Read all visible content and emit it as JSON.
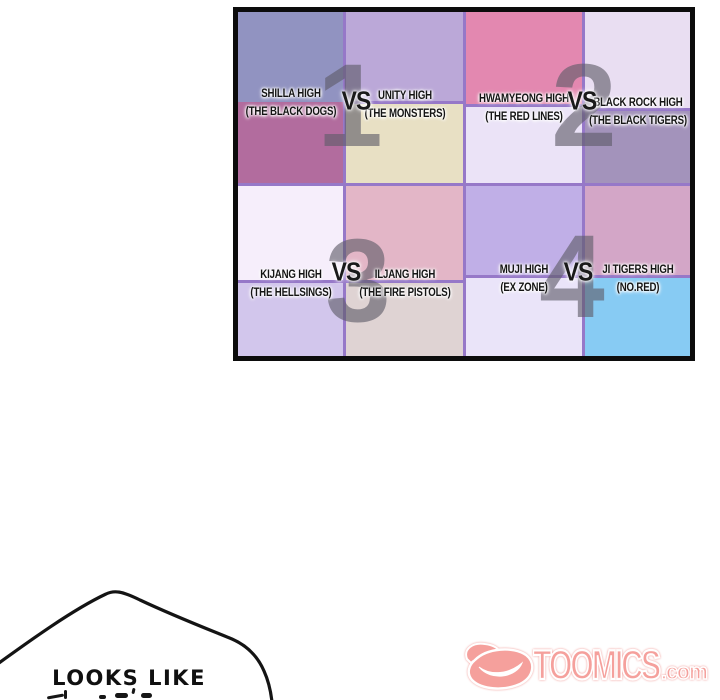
{
  "bracket": {
    "matches": [
      {
        "number": "1",
        "vs": "VS"
      },
      {
        "number": "2",
        "vs": "VS"
      },
      {
        "number": "3",
        "vs": "VS"
      },
      {
        "number": "4",
        "vs": "VS"
      }
    ],
    "cells": [
      {
        "school": "SHILLA HIGH",
        "team": "(THE BLACK DOGS)",
        "top_color": "#9193c1",
        "bottom_color": "#b26c9e"
      },
      {
        "school": "UNITY HIGH",
        "team": "(THE MONSTERS)",
        "top_color": "#bba8d8",
        "bottom_color": "#e8e0c4"
      },
      {
        "school": "HWAMYEONG HIGH",
        "team": "(THE RED LINES)",
        "top_color": "#e388b0",
        "bottom_color": "#ebe3f7"
      },
      {
        "school": "BLACK ROCK HIGH",
        "team": "(THE BLACK TIGERS)",
        "top_color": "#e9def2",
        "bottom_color": "#a393bb"
      },
      {
        "school": "KIJANG HIGH",
        "team": "(THE HELLSINGS)",
        "top_color": "#f6eefb",
        "bottom_color": "#d2c6ec"
      },
      {
        "school": "ILJANG HIGH",
        "team": "(THE FIRE PISTOLS)",
        "top_color": "#e3b6c7",
        "bottom_color": "#dfd3d3"
      },
      {
        "school": "MUJI HIGH",
        "team": "(EX ZONE)",
        "top_color": "#c0afe7",
        "bottom_color": "#eae4f9"
      },
      {
        "school": "JI TIGERS HIGH",
        "team": "(NO.RED)",
        "top_color": "#d3a6c7",
        "bottom_color": "#87cbf3"
      }
    ],
    "grid_line_color": "#9678c8",
    "border_color": "#0c0c0c",
    "number_color": "#5f5c69"
  },
  "speech_bubble": {
    "line1": "LOOKS LIKE"
  },
  "watermark": {
    "name": "TOOMICS",
    "domain": ".com",
    "color": "#f5a09c"
  }
}
